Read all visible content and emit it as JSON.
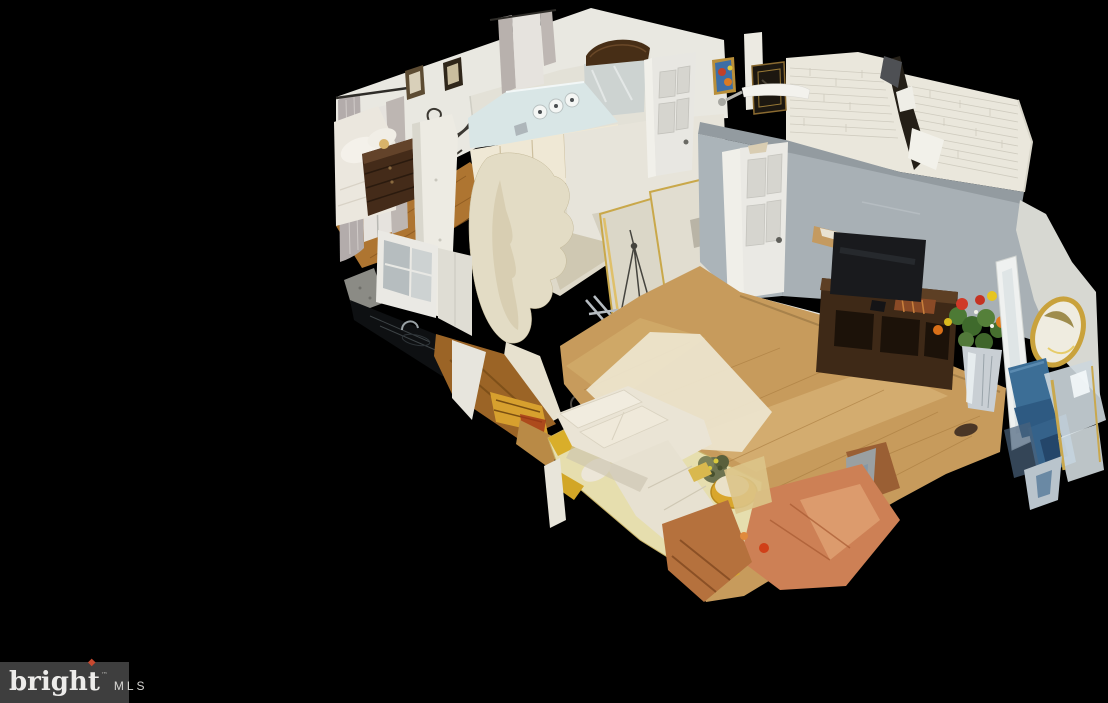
{
  "watermark": {
    "brand_prefix": "brigh",
    "brand_last": "t",
    "flame_glyph": "◆",
    "trademark": "™",
    "suffix": "MLS",
    "background_color": "#3e3e3e",
    "text_color": "#edecea",
    "flame_color": "#c8492f"
  },
  "scene": {
    "background_color": "#000000",
    "palette": {
      "wall_white": "#e9e8e1",
      "wall_gray_blue": "#a9b1b6",
      "brick_white": "#eae7dc",
      "floor_oak": "#c79b5c",
      "floor_bedroom": "#ae7531",
      "sofa_cream": "#eae4d5",
      "rug_yellow": "#e6deae",
      "dark_wood": "#41291a",
      "torn_orange": "#cd8055",
      "chair_blue": "#3c6e96",
      "mirror_gold": "#c9a84a",
      "counter_black": "#0e1012"
    }
  }
}
